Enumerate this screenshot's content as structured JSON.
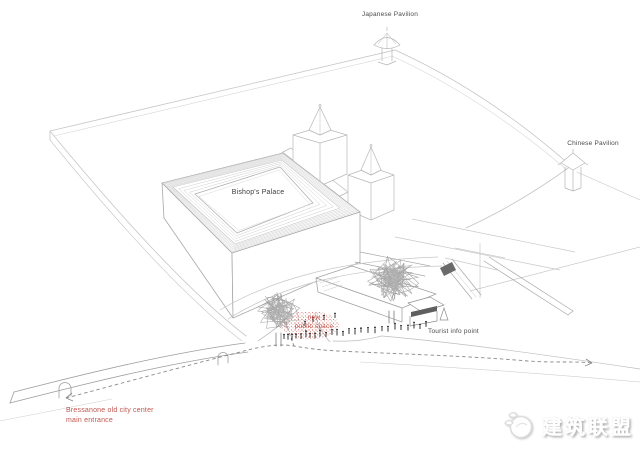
{
  "diagram": {
    "labels": {
      "japanese_pavilion": "Japanese Pavilion",
      "chinese_pavilion": "Chinese Pavilion",
      "bishops_palace": "Bishop's Palace",
      "new_public_space_line1": "new",
      "new_public_space_line2": "public space",
      "tourist_info_point": "Tourist info point",
      "entrance_line1": "Bressanone old city center",
      "entrance_line2": "main entrance"
    },
    "colors": {
      "accent_red": "#bf544e",
      "label_gray": "#4a4a4a",
      "line_gray": "#c3c3c3",
      "stipple_red": "#cf5f57"
    }
  },
  "logo": {
    "text": "建筑联盟"
  }
}
